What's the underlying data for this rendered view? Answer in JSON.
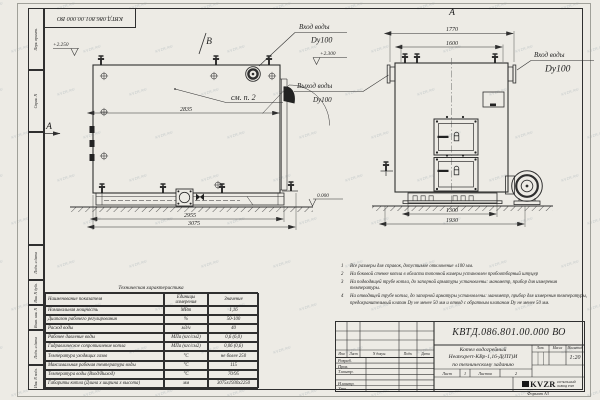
{
  "frame": {
    "top_stamp": "КВТД.086.801.00.000 ВО",
    "margin_labels": [
      "Перв. примен.",
      "Справ. N",
      "Подп. и дата",
      "Инв. N дубл.",
      "Взам. инв. N",
      "Подп. и дата",
      "Инв. N подл."
    ],
    "format_note": "Формат А3"
  },
  "watermark": "KVZR.RU",
  "views": {
    "front": {
      "marker_b": "В",
      "marker_a": "А",
      "elev_left": "+2.250",
      "elev_right": "+2.300",
      "elev_zero": "0.000",
      "see_note": "см. п. 2",
      "dim_inner": "2835",
      "dim_w1": "2955",
      "dim_w2": "3075",
      "inlet": "Вход воды",
      "inlet_dn": "Dy100"
    },
    "side": {
      "marker": "А",
      "dim_t1": "1770",
      "dim_t2": "1600",
      "dim_b1": "1300",
      "dim_b2": "1930",
      "outlet": "Выход воды",
      "outlet_dn": "Dy100",
      "inlet": "Вход воды",
      "inlet_dn": "Dy100"
    }
  },
  "notes": {
    "items": [
      "Все размеры для справок, допустимое отклонение ±100 мм.",
      "На боковой стенке котла в области топочной камеры установлен пробоотборный штуцер",
      "На подводящей трубе котла, до запорной арматуры установлены: манометр, прибор для измерения температуры.",
      "На отводящей трубе котла, до запорной арматуры установлены: манометр, прибор для измерения температуры, предохранительный клапан Dу не менее 50 мм и отвод с обратным клапаном Dу не менее 50 мм."
    ]
  },
  "table": {
    "title": "Техническая характеристика",
    "headers": [
      "Наименование показателя",
      "Единицы измерения",
      "Значение"
    ],
    "rows": [
      [
        "Номинальная мощность",
        "МВт",
        "1,16"
      ],
      [
        "Диапазон рабочего регулирования",
        "%",
        "50-100"
      ],
      [
        "Расход воды",
        "м3/ч",
        "40"
      ],
      [
        "Рабочее давление воды",
        "МПа (кгс/см2)",
        "0,6 (6,0)"
      ],
      [
        "Гидравлическое сопротивление котла",
        "МПа (кгс/см2)",
        "0,06 (0,6)"
      ],
      [
        "Температура уходящих газов",
        "°С",
        "не более 250"
      ],
      [
        "Максимальная рабочая температура воды",
        "°С",
        "115"
      ],
      [
        "Температура воды (Вход/Выход)",
        "°С",
        "70/95"
      ],
      [
        "Габариты котла (Длина х ширина х высота)",
        "мм",
        "3075х1930х2250"
      ]
    ]
  },
  "title_block": {
    "doc_number": "КВТД.086.801.00.000 ВО",
    "rev_headers": [
      "Изм",
      "Лист",
      "N докум.",
      "Подп.",
      "Дата"
    ],
    "sign_rows": [
      "Разраб.",
      "Пров.",
      "Т.контр.",
      "",
      "Н.контр.",
      "Утв."
    ],
    "product_lines": [
      "Котел водогрейный",
      "Heatexpert-КВр-1,16-Д(ПТ)И",
      "по техническому заданию"
    ],
    "lit_label": "Лит.",
    "mass_label": "Масса",
    "scale_label": "Масштаб",
    "scale_value": "1:20",
    "sheet_label": "Лист",
    "sheet_value": "1",
    "sheets_label": "Листов",
    "sheets_value": "2",
    "logo_text": "KVZR",
    "logo_sub1": "КОТЕЛЬНЫЙ",
    "logo_sub2": "ЗАВОД РЭП"
  }
}
